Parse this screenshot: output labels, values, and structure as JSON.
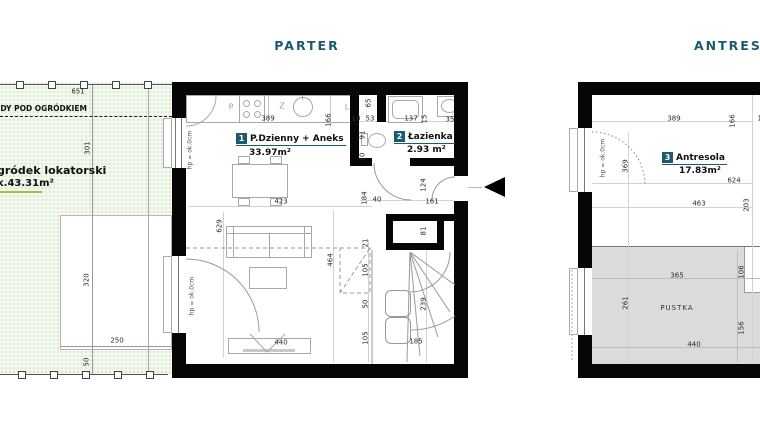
{
  "titles": {
    "parter": "PARTER",
    "antresola": "ANTRESOLA"
  },
  "colors": {
    "accent": "#1b5a70",
    "wall": "#060606",
    "garden_fill": "#f3f8ee",
    "garden_dot": "#a7c795",
    "pustka_fill": "#dbdbdb",
    "underline_green": "#a9bf44"
  },
  "garden": {
    "boundary_text": "ODY POD OGRÓDKIEM",
    "name": "gródek lokatorski",
    "area": "k.43.31m²"
  },
  "rooms": [
    {
      "number": "1",
      "name": "P.Dzienny + Aneks",
      "area": "33.97m²"
    },
    {
      "number": "2",
      "name": "Łazienka",
      "area": "2.93 m²"
    },
    {
      "number": "3",
      "name": "Antresola",
      "area": "17.83m²"
    }
  ],
  "labels": {
    "pustka": "PUSTKA",
    "hp": "hp = ok.0cm",
    "kitchen_p": "P",
    "kitchen_z": "Z",
    "kitchen_l": "L"
  },
  "dimensions": {
    "garden": [
      {
        "t": "651",
        "x": 78,
        "y": 92
      },
      {
        "t": "301",
        "x": 88,
        "y": 148,
        "v": 1
      },
      {
        "t": "320",
        "x": 87,
        "y": 280,
        "v": 1
      },
      {
        "t": "250",
        "x": 117,
        "y": 341
      },
      {
        "t": "50",
        "x": 87,
        "y": 362,
        "v": 1
      }
    ],
    "parter": [
      {
        "t": "389",
        "x": 268,
        "y": 119
      },
      {
        "t": "166",
        "x": 329,
        "y": 120,
        "v": 1
      },
      {
        "t": "10",
        "x": 356,
        "y": 119
      },
      {
        "t": "53",
        "x": 370,
        "y": 119
      },
      {
        "t": "137",
        "x": 411,
        "y": 119
      },
      {
        "t": "15",
        "x": 425,
        "y": 119,
        "v": 1
      },
      {
        "t": "35",
        "x": 450,
        "y": 120
      },
      {
        "t": "65",
        "x": 369,
        "y": 103,
        "v": 1
      },
      {
        "t": "91",
        "x": 363,
        "y": 135,
        "v": 1
      },
      {
        "t": "10",
        "x": 363,
        "y": 157,
        "v": 1
      },
      {
        "t": "124",
        "x": 424,
        "y": 185,
        "v": 1
      },
      {
        "t": "184",
        "x": 365,
        "y": 198,
        "v": 1
      },
      {
        "t": "40",
        "x": 377,
        "y": 200
      },
      {
        "t": "161",
        "x": 432,
        "y": 202
      },
      {
        "t": "81",
        "x": 424,
        "y": 231,
        "v": 1
      },
      {
        "t": "423",
        "x": 281,
        "y": 202
      },
      {
        "t": "629",
        "x": 220,
        "y": 226,
        "v": 1
      },
      {
        "t": "464",
        "x": 331,
        "y": 260,
        "v": 1
      },
      {
        "t": "21",
        "x": 366,
        "y": 243,
        "v": 1
      },
      {
        "t": "105",
        "x": 366,
        "y": 270,
        "v": 1
      },
      {
        "t": "50",
        "x": 366,
        "y": 304,
        "v": 1
      },
      {
        "t": "105",
        "x": 366,
        "y": 338,
        "v": 1
      },
      {
        "t": "239",
        "x": 424,
        "y": 304,
        "v": 1
      },
      {
        "t": "185",
        "x": 416,
        "y": 342
      },
      {
        "t": "440",
        "x": 281,
        "y": 343
      }
    ],
    "antresola": [
      {
        "t": "389",
        "x": 674,
        "y": 119
      },
      {
        "t": "166",
        "x": 733,
        "y": 121,
        "v": 1
      },
      {
        "t": "10",
        "x": 762,
        "y": 119
      },
      {
        "t": "369",
        "x": 626,
        "y": 166,
        "v": 1
      },
      {
        "t": "624",
        "x": 734,
        "y": 181
      },
      {
        "t": "463",
        "x": 699,
        "y": 204
      },
      {
        "t": "203",
        "x": 747,
        "y": 205,
        "v": 1
      },
      {
        "t": "365",
        "x": 677,
        "y": 276
      },
      {
        "t": "106",
        "x": 742,
        "y": 272,
        "v": 1
      },
      {
        "t": "261",
        "x": 626,
        "y": 303,
        "v": 1
      },
      {
        "t": "156",
        "x": 742,
        "y": 328,
        "v": 1
      },
      {
        "t": "440",
        "x": 694,
        "y": 345
      }
    ]
  }
}
